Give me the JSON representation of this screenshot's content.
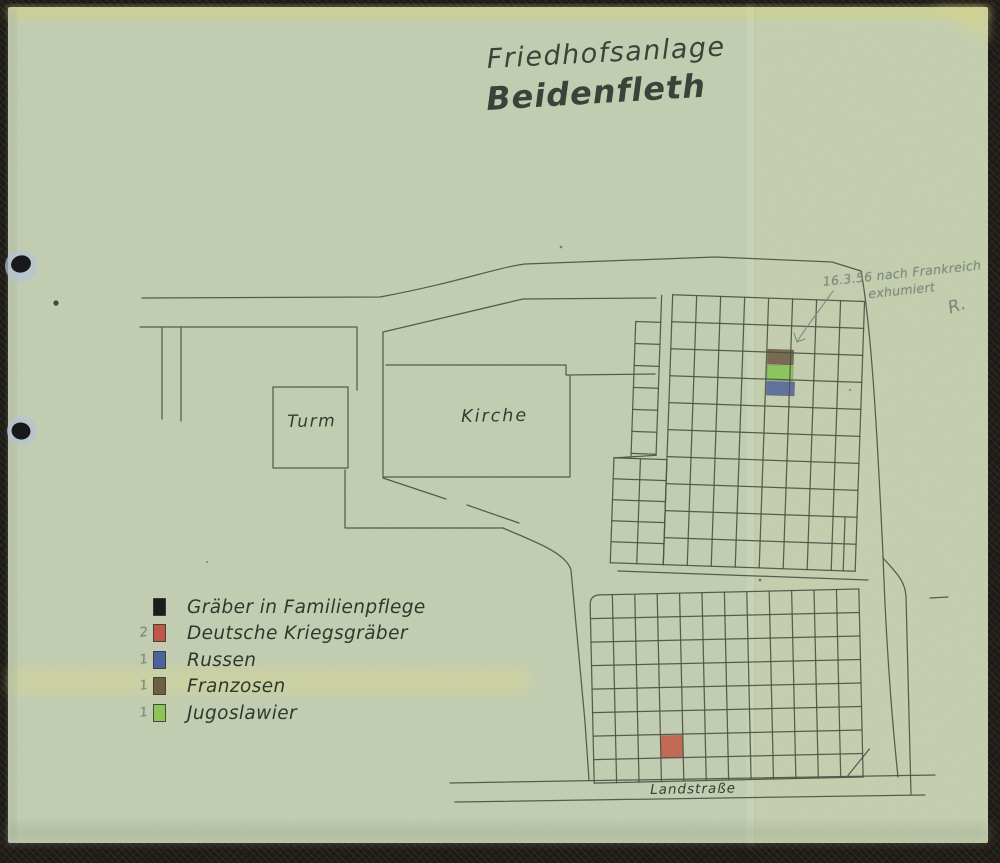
{
  "title": {
    "line1": "Friedhofsanlage",
    "line2": "Beidenfleth"
  },
  "map_labels": {
    "tower": "Turm",
    "church": "Kirche",
    "road": "Landstraße"
  },
  "annotation": {
    "line1": "16.3.56 nach Frankreich",
    "line2": "exhumiert",
    "initials": "R."
  },
  "legend": {
    "items": [
      {
        "count": "",
        "label": "Gräber in Familienpflege",
        "color": "#1d1d1d"
      },
      {
        "count": "2",
        "label": "Deutsche Kriegsgräber",
        "color": "#c0584a"
      },
      {
        "count": "1",
        "label": "Russen",
        "color": "#50629b"
      },
      {
        "count": "1",
        "label": "Franzosen",
        "color": "#6f5e46"
      },
      {
        "count": "1",
        "label": "Jugoslawier",
        "color": "#8cc455"
      }
    ]
  },
  "plot_markers": {
    "franzosen": "#6f5e46",
    "jugoslawier": "#86c653",
    "russen": "#50629b",
    "deutsche": "#c4604e"
  },
  "paper": {
    "background": "#c6d1b4",
    "ink": "#4a5445",
    "pencil": "#7d8b7e"
  }
}
